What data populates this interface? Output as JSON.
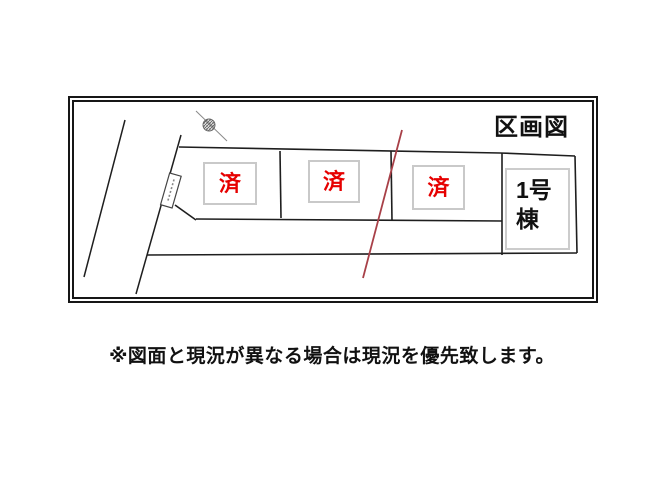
{
  "plan": {
    "title": "区画図",
    "lots": [
      {
        "label": "済"
      },
      {
        "label": "済"
      },
      {
        "label": "済"
      }
    ],
    "building": {
      "line1": "1号",
      "line2": "棟"
    },
    "colors": {
      "sold_text": "#e60000",
      "drawing_line": "#1e1e1e",
      "red_boundary_line": "#a84048",
      "status_box_border": "#c9c9c9",
      "frame_border": "#161616"
    }
  },
  "caption": {
    "text": "※図面と現況が異なる場合は現況を優先致します。"
  }
}
